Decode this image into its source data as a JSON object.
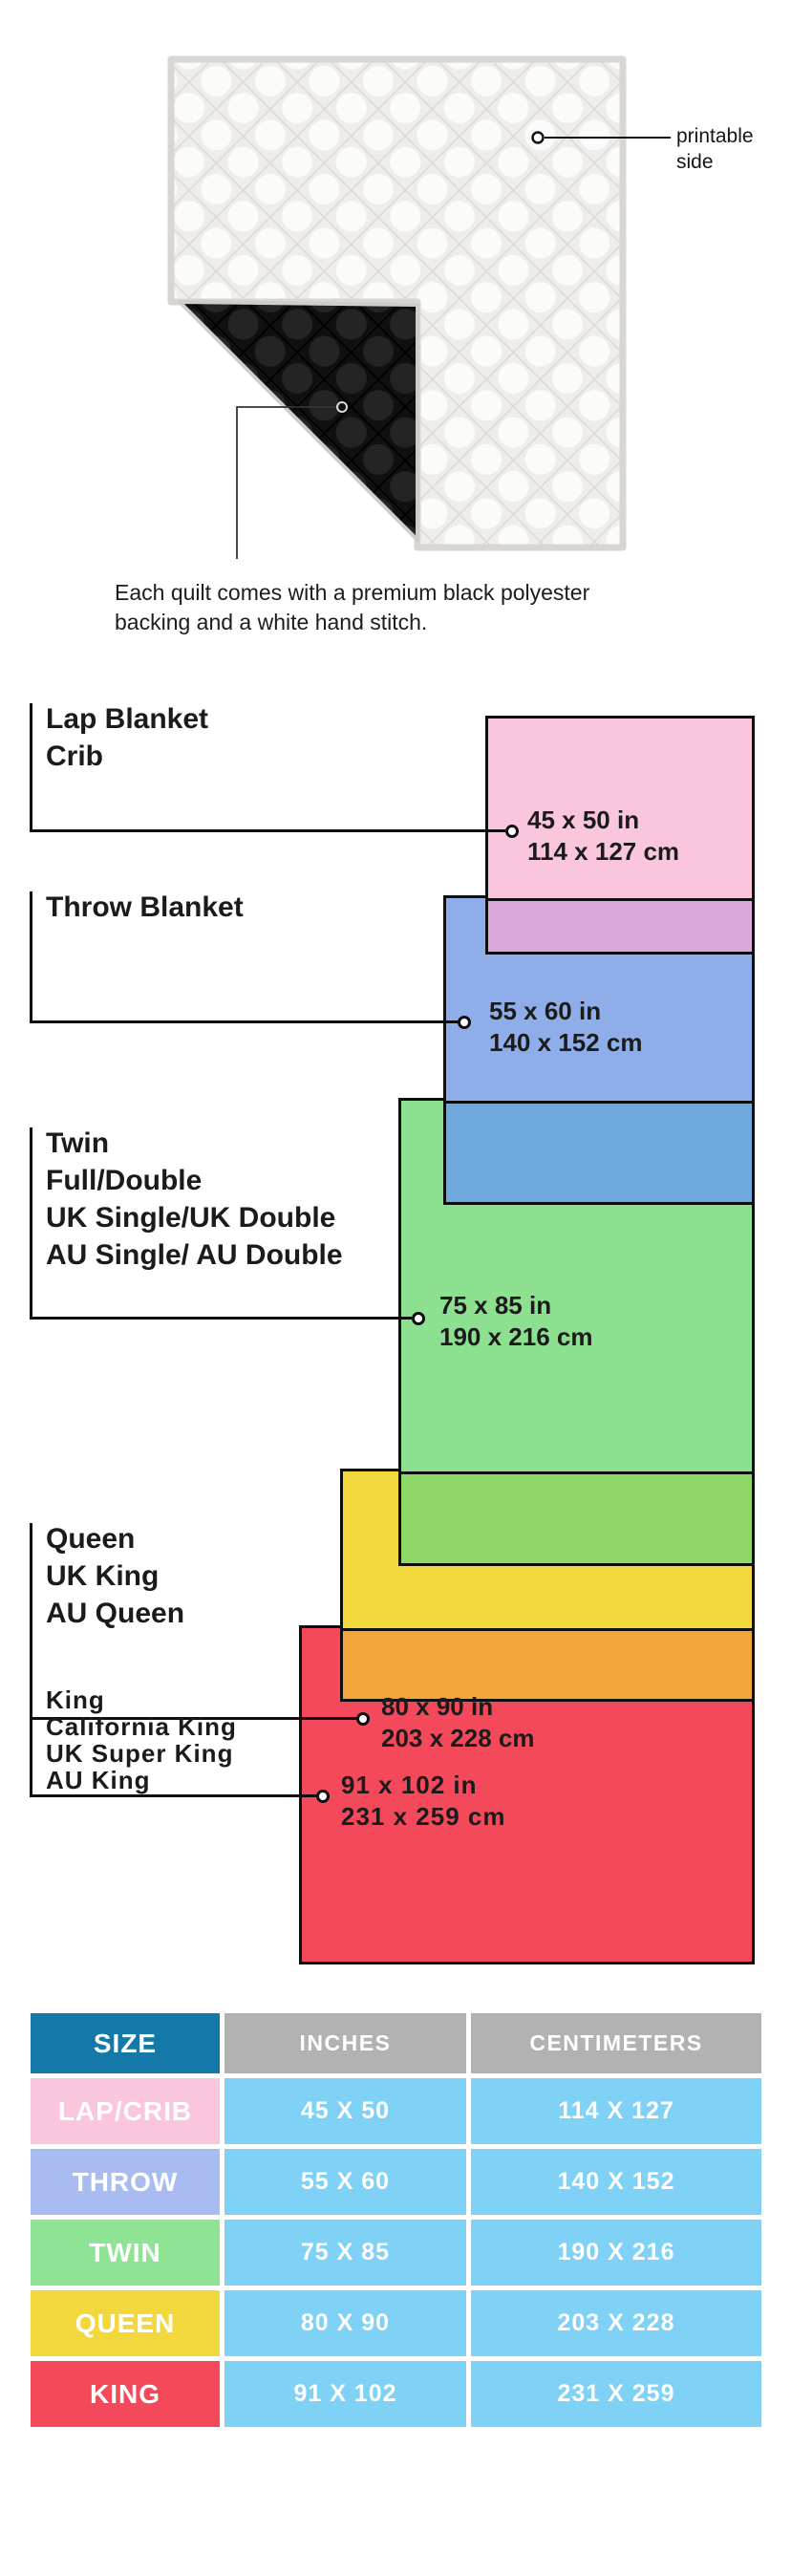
{
  "hero": {
    "printable_side": "printable side",
    "caption_line1": "Each quilt comes with a premium black polyester",
    "caption_line2": "backing and a white hand stitch."
  },
  "diagram": {
    "sizes": [
      {
        "id": "lap",
        "labels": [
          "Lap Blanket",
          "Crib"
        ],
        "inches": "45 x 50 in",
        "cm": "114 x 127 cm",
        "fill": "#FAC6DD",
        "overlap_fill": "#D9A9DC"
      },
      {
        "id": "throw",
        "labels": [
          "Throw Blanket"
        ],
        "inches": "55 x 60 in",
        "cm": "140 x 152 cm",
        "fill": "#8FAEE9",
        "overlap_fill": "#6FA9DE"
      },
      {
        "id": "twin",
        "labels": [
          "Twin",
          "Full/Double",
          "UK Single/UK Double",
          "AU Single/ AU Double"
        ],
        "inches": "75 x 85 in",
        "cm": "190 x 216 cm",
        "fill": "#8EE091",
        "overlap_fill": "#8FD768"
      },
      {
        "id": "queen",
        "labels": [
          "Queen",
          "UK King",
          "AU Queen"
        ],
        "inches": "80 x 90 in",
        "cm": "203 x 228 cm",
        "fill": "#F2D73D",
        "overlap_fill": "#F2A63B"
      },
      {
        "id": "king",
        "labels": [
          "King",
          "California King",
          "UK Super King",
          "AU King"
        ],
        "inches": "91 x 102 in",
        "cm": "231 x 259 cm",
        "fill": "#F4495A",
        "overlap_fill": null
      }
    ],
    "border_color": "#0f0f0f"
  },
  "table": {
    "headers": {
      "size": "SIZE",
      "inches": "INCHES",
      "cm": "CENTIMETERS"
    },
    "header_size_bg": "#1478A8",
    "header_measure_bg": "#B2B2B2",
    "value_bg": "#7FD1F5",
    "rows": [
      {
        "size": "LAP/CRIB",
        "inches": "45 X 50",
        "cm": "114 X 127",
        "bg": "#FAC6DD"
      },
      {
        "size": "THROW",
        "inches": "55 X 60",
        "cm": "140 X 152",
        "bg": "#A9BCF2"
      },
      {
        "size": "TWIN",
        "inches": "75 X 85",
        "cm": "190 X 216",
        "bg": "#8EE394"
      },
      {
        "size": "QUEEN",
        "inches": "80 X 90",
        "cm": "203 X 228",
        "bg": "#F2D73D"
      },
      {
        "size": "KING",
        "inches": "91 X 102",
        "cm": "231 X 259",
        "bg": "#F4495A"
      }
    ]
  }
}
